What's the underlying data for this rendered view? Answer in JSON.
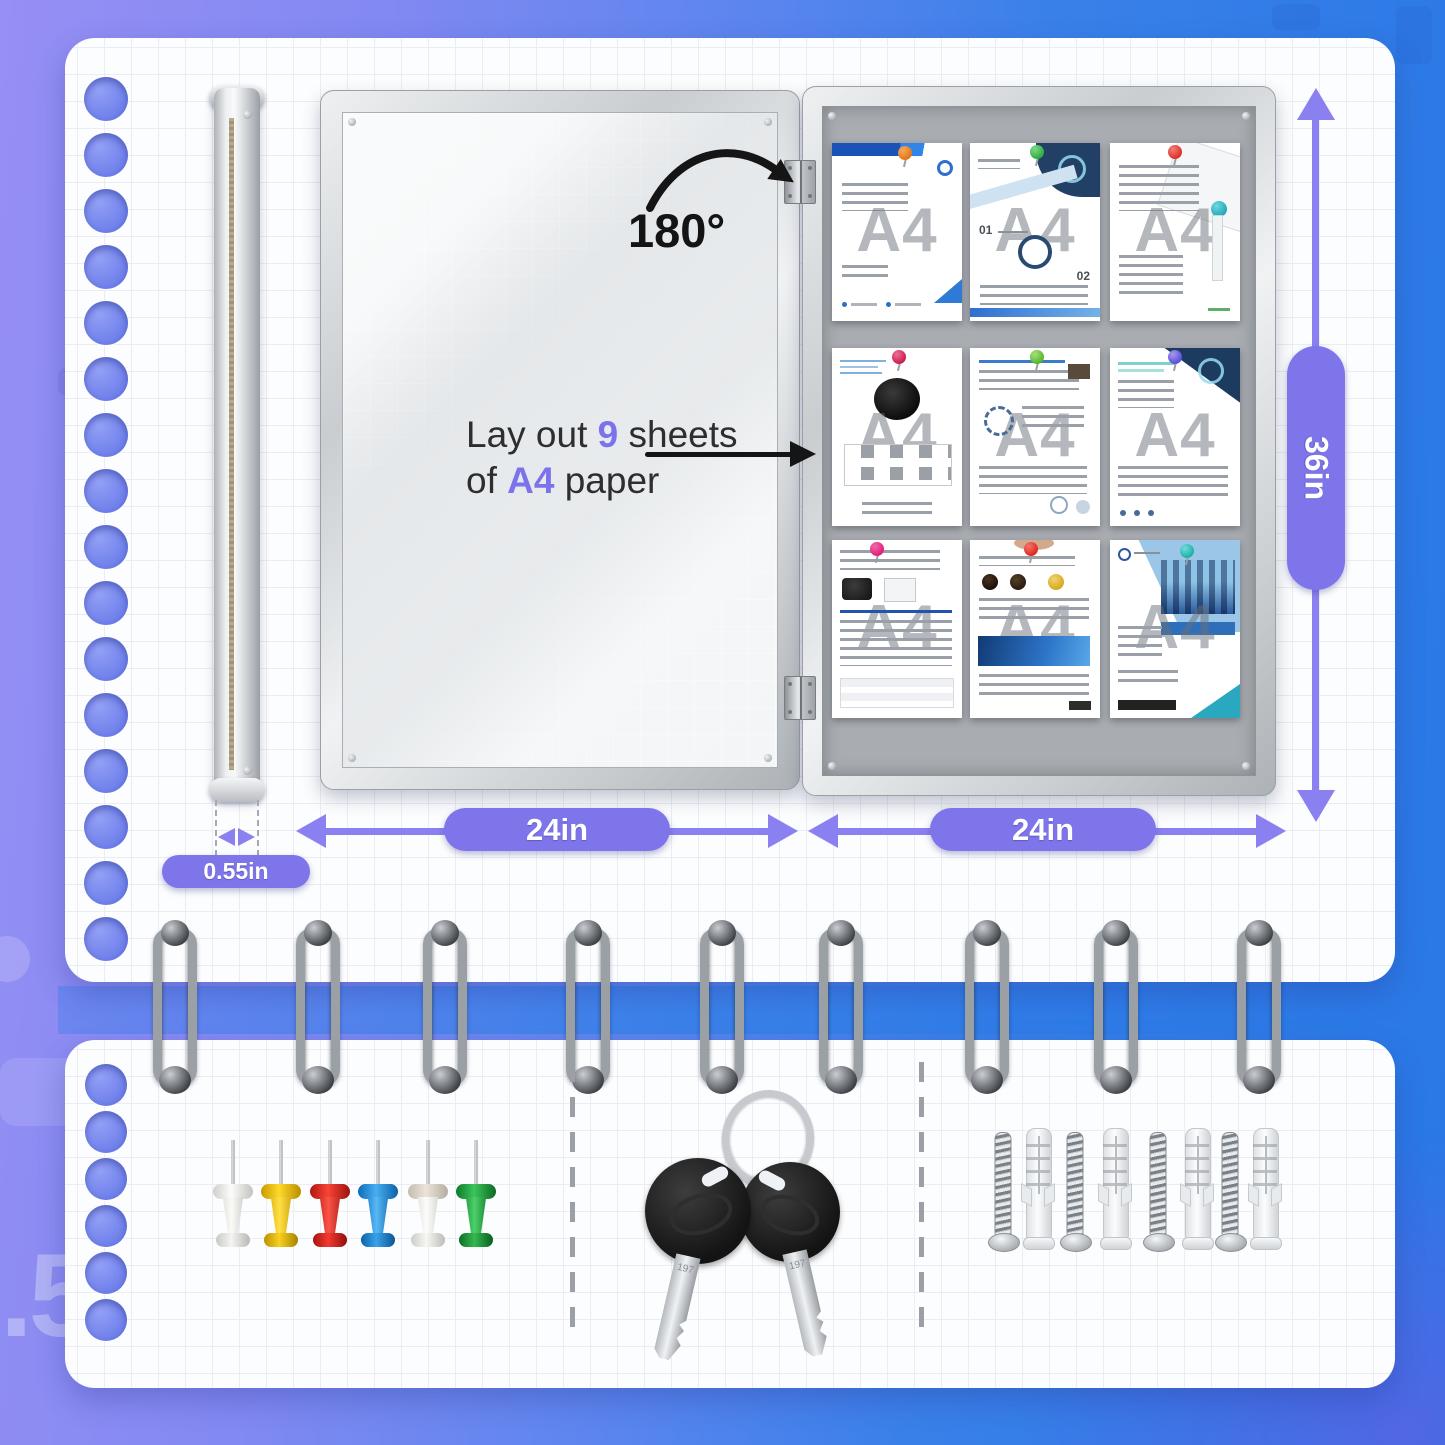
{
  "colors": {
    "background_left": "#968ff4",
    "background_right": "#2878e6",
    "accent_purple": "#8b80f0",
    "pill_purple": "#7e75ea",
    "band_blue": "#2f7ce8",
    "felt_gray": "#a9adb2",
    "frame_silver": "#d7dadd",
    "note_text": "#2e2e2e",
    "annotation_black": "#151515",
    "pushpin_colors_hex": [
      "#f2f2f0",
      "#f5c400",
      "#e32219",
      "#1e8fe0",
      "#efefec",
      "#1fa33c"
    ],
    "sheet_pin_colors_hex": [
      "#e07818",
      "#2fae3f",
      "#e03028",
      "#cc1f4e",
      "#55b82a",
      "#5b4fd8",
      "#e01f7a",
      "#e02820",
      "#1fb0ad"
    ]
  },
  "annotations": {
    "angle_label": "180°",
    "note_l1_a": "Lay out ",
    "note_l1_b": "9",
    "note_l1_c": " sheets",
    "note_l2_a": "of ",
    "note_l2_b": "A4",
    "note_l2_c": " paper"
  },
  "dimensions": {
    "height": "36in",
    "door_width": "24in",
    "board_width": "24in",
    "thickness": "0.55in"
  },
  "board": {
    "sheet_count": 9,
    "watermark": "A4",
    "sheet2_step1": "01",
    "sheet2_step2": "02",
    "pin_colors": [
      "orange",
      "green",
      "red",
      "crimson",
      "green",
      "purple",
      "magenta",
      "red",
      "teal"
    ]
  },
  "accessories": {
    "pushpin_count": 6,
    "pushpin_colors": [
      "white",
      "yellow",
      "red",
      "blue",
      "white",
      "green"
    ],
    "key_count": 2,
    "key_stamp": "197",
    "screw_count": 4,
    "anchor_count": 4
  },
  "backdrop": {
    "decor_fragment": ".5"
  }
}
